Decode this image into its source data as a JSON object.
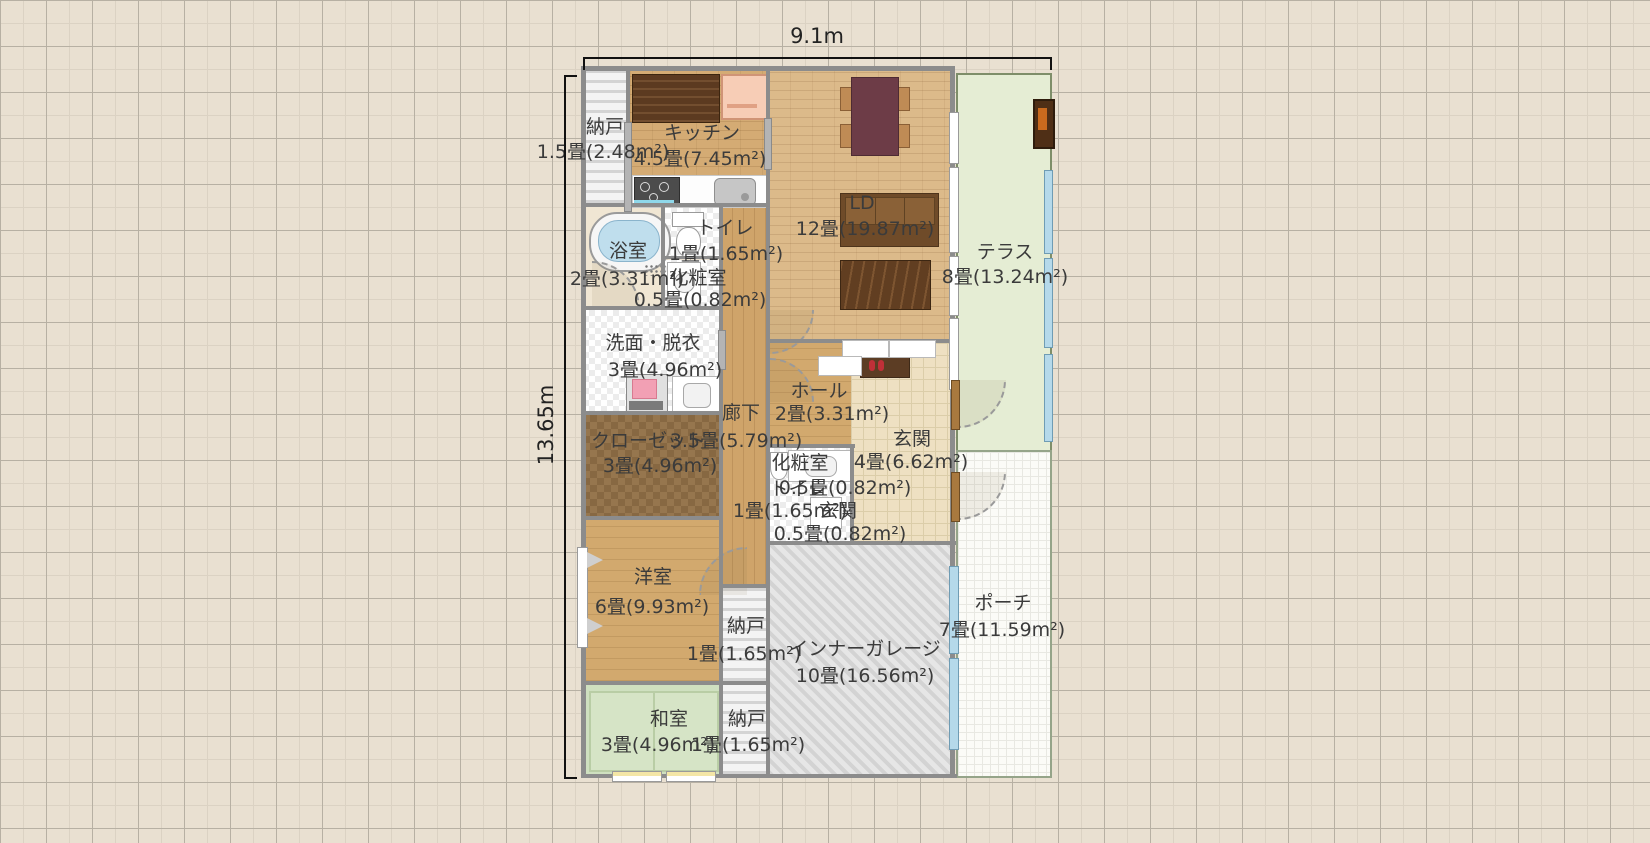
{
  "plan": {
    "width_label": "9.1m",
    "height_label": "13.65m"
  },
  "rooms": [
    {
      "name": "納戸",
      "size": "1.5畳(2.48m²)"
    },
    {
      "name": "キッチン",
      "size": "4.5畳(7.45m²)"
    },
    {
      "name": "LD",
      "size": "12畳(19.87m²)"
    },
    {
      "name": "テラス",
      "size": "8畳(13.24m²)"
    },
    {
      "name": "浴室",
      "size": "2畳(3.31m²)"
    },
    {
      "name": "トイレ",
      "size": "1畳(1.65m²)"
    },
    {
      "name": "化粧室",
      "size": "0.5畳(0.82m²)"
    },
    {
      "name": "洗面・脱衣",
      "size": "3畳(4.96m²)"
    },
    {
      "name": "廊下",
      "size": "3.5畳(5.79m²)"
    },
    {
      "name": "ホール",
      "size": "2畳(3.31m²)"
    },
    {
      "name": "玄関",
      "size": "4畳(6.62m²)"
    },
    {
      "name": "化粧室",
      "size": "0.5畳(0.82m²)"
    },
    {
      "name": "トイレ",
      "size": "1畳(1.65m²)"
    },
    {
      "name": "玄関",
      "size": "0.5畳(0.82m²)"
    },
    {
      "name": "クローゼット",
      "size": "3畳(4.96m²)"
    },
    {
      "name": "洋室",
      "size": "6畳(9.93m²)"
    },
    {
      "name": "納戸",
      "size": "1畳(1.65m²)"
    },
    {
      "name": "インナーガレージ",
      "size": "10畳(16.56m²)"
    },
    {
      "name": "ポーチ",
      "size": "7畳(11.59m²)"
    },
    {
      "name": "和室",
      "size": "3畳(4.96m²)"
    },
    {
      "name": "納戸",
      "size": "1畳(1.65m²)"
    }
  ],
  "colors": {
    "background": "#e9e0d1",
    "wood_floor": "#d4ab74",
    "tatami": "#cfe0c0",
    "terrace": "#e5edd4",
    "garage": "#e2e2e2",
    "wall": "#8c8c8c",
    "window_glass": "#b5d9ea",
    "text": "#3b3b3b"
  }
}
